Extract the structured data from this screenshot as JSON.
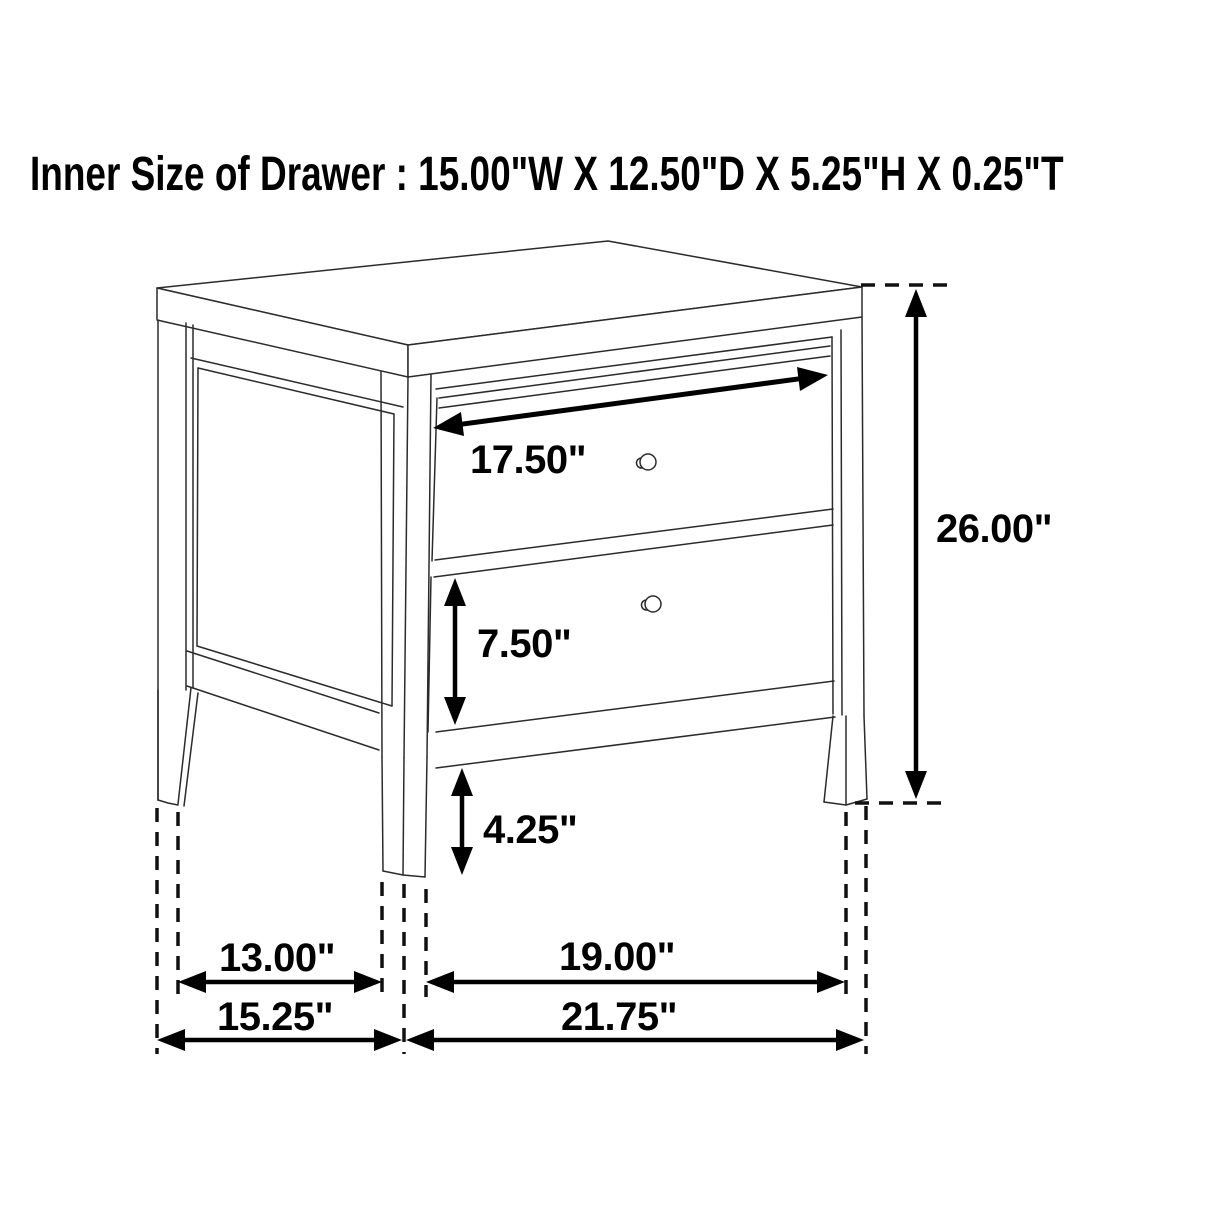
{
  "title": "Inner Size of Drawer : 15.00\"W X 12.50\"D X 5.25\"H X 0.25\"T",
  "diagram": {
    "item": "two-drawer nightstand",
    "view": "three-quarter perspective line drawing with dimension arrows",
    "background_color": "#ffffff",
    "line_color": "#2b2b2b",
    "dimension_color": "#000000",
    "labels": {
      "drawer_front_width": "17.50\"",
      "bottom_drawer_height": "7.50\"",
      "floor_clearance": "4.25\"",
      "overall_height": "26.00\"",
      "side_leg_inner_spacing": "13.00\"",
      "front_leg_inner_spacing": "19.00\"",
      "overall_depth": "15.25\"",
      "overall_width": "21.75\""
    }
  }
}
